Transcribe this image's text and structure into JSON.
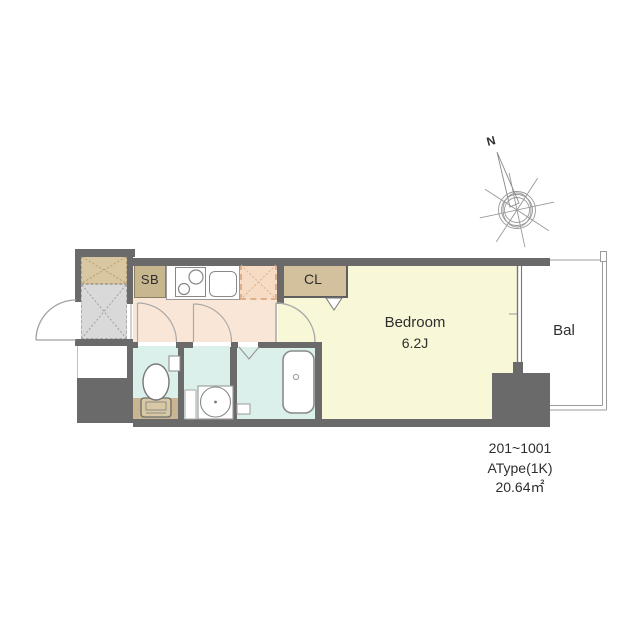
{
  "title": "Apartment unit floor plan",
  "palette": {
    "wall": "#6a6a6a",
    "corridor_floor": "#fae6d7",
    "bedroom_floor": "#f8f8d8",
    "wet_area_floor": "#dbf0ea",
    "closet_tan": "#d3c09c",
    "shoe_box_tan": "#c8b78e",
    "entrance_gray": "#d9d9d9",
    "storage_tan": "#d9c7a2",
    "fridge_space_peach": "#f6dbc5",
    "toilet_mat_tan": "#c9b690",
    "line_gray": "#9a9a9a"
  },
  "floorplan": {
    "labels": {
      "shoe_box": "SB",
      "closet": "CL",
      "bedroom": "Bedroom",
      "bedroom_size": "6.2J",
      "balcony": "Bal",
      "compass_north": "N"
    },
    "info": {
      "floors": "201~1001",
      "unit_type": "AType(1K)",
      "area": "20.64㎡"
    }
  }
}
